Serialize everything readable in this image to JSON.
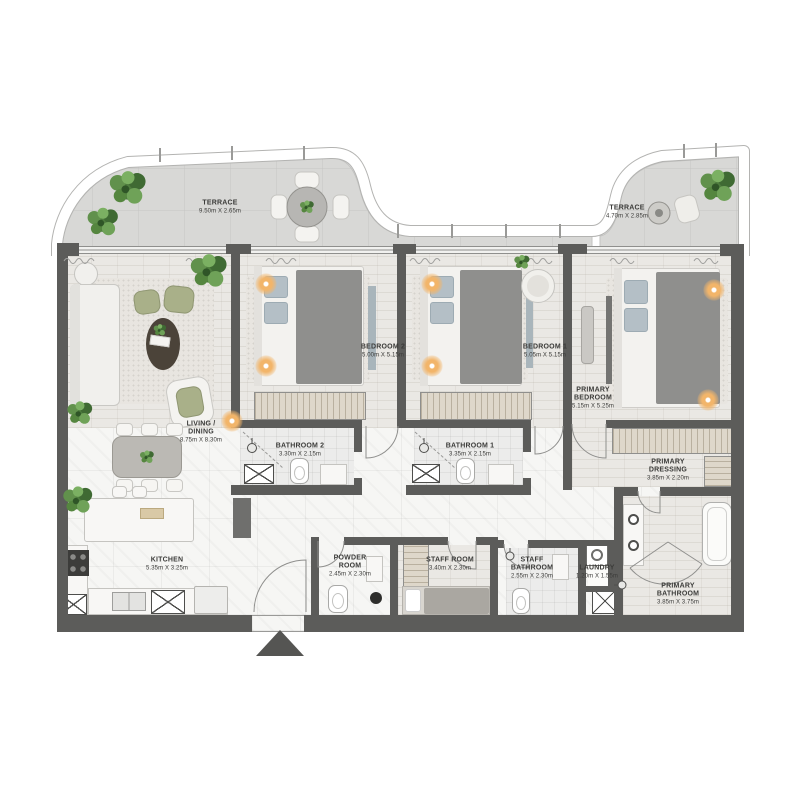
{
  "floor_plan": {
    "rooms": {
      "terrace_left": {
        "name": "TERRACE",
        "dims": "9.50m X 2.65m"
      },
      "terrace_right": {
        "name": "TERRACE",
        "dims": "4.70m X 2.85m"
      },
      "living_dining": {
        "name": "LIVING /\nDINING",
        "dims": "8.75m X 8.30m"
      },
      "bedroom_2": {
        "name": "BEDROOM 2",
        "dims": "5.00m X 5.15m"
      },
      "bedroom_1": {
        "name": "BEDROOM 1",
        "dims": "5.05m X 5.15m"
      },
      "primary_bedroom": {
        "name": "PRIMARY\nBEDROOM",
        "dims": "5.15m X 5.25m"
      },
      "bathroom_2": {
        "name": "BATHROOM 2",
        "dims": "3.30m X 2.15m"
      },
      "bathroom_1": {
        "name": "BATHROOM 1",
        "dims": "3.35m X 2.15m"
      },
      "primary_dressing": {
        "name": "PRIMARY\nDRESSING",
        "dims": "3.85m X 2.20m"
      },
      "kitchen": {
        "name": "KITCHEN",
        "dims": "5.35m X 3.25m"
      },
      "powder_room": {
        "name": "POWDER\nROOM",
        "dims": "2.45m X 2.30m"
      },
      "staff_room": {
        "name": "STAFF ROOM",
        "dims": "3.40m X 2.30m"
      },
      "staff_bathroom": {
        "name": "STAFF\nBATHROOM",
        "dims": "2.55m X 2.30m"
      },
      "laundry": {
        "name": "LAUNDRY",
        "dims": "1.20m X 1.55m"
      },
      "primary_bathroom": {
        "name": "PRIMARY\nBATHROOM",
        "dims": "3.85m X 3.75m"
      }
    },
    "colors": {
      "wall": "#5c5c5a",
      "terrace_tile": "#d8d8d6",
      "plant_green": "#4e7c3e",
      "accent_wood": "#ded7ca",
      "light_glow": "#f2b56a"
    }
  }
}
